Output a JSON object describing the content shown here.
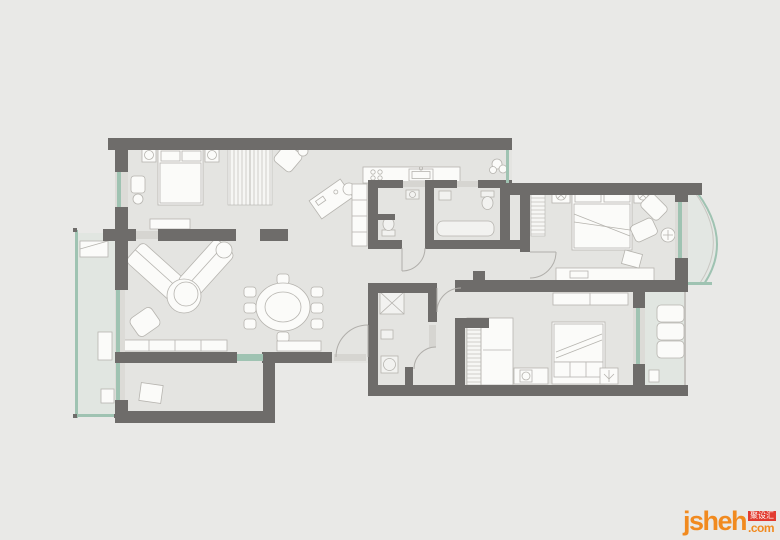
{
  "watermark": {
    "brand": "jsheh",
    "badge": "聚设汇",
    "suffix": ".com"
  },
  "palette": {
    "page-bg": "#e9e9e7",
    "floor": "#e4e4e1",
    "balcony-floor": "#e1e6e1",
    "wall": "#6e6c6a",
    "furniture": "#fbfbf9",
    "furniture-outline": "#b6b4af",
    "glass": "#9fc3b2",
    "door": "#d6d5d1",
    "arc": "#b0aeaa",
    "hatch": "#c7c5c0",
    "brand-orange": "#f18a1f",
    "brand-red": "#e23b30",
    "brand-white": "#ffffff"
  },
  "floorplan": {
    "type": "apartment-floor-plan",
    "rooms": [
      "bedroom-top-left",
      "study-area",
      "kitchen",
      "bathroom-a",
      "bathroom-b",
      "living-room",
      "dining-area",
      "entry",
      "corridor",
      "master-bedroom",
      "bathroom-2",
      "bedroom-2",
      "balcony-left",
      "balcony-right-curved",
      "balcony-bottom-right",
      "nook"
    ],
    "furniture": [
      "double-bed",
      "nightstands",
      "wardrobes",
      "desk",
      "kitchen-counter",
      "sink",
      "sectional-sofa",
      "coffee-table",
      "armchair",
      "tv-cabinet",
      "dining-table",
      "dining-chairs",
      "master-bed",
      "lounge-chairs",
      "dresser",
      "bed-2",
      "balcony-bench",
      "toilet",
      "bathtub",
      "washer"
    ]
  }
}
